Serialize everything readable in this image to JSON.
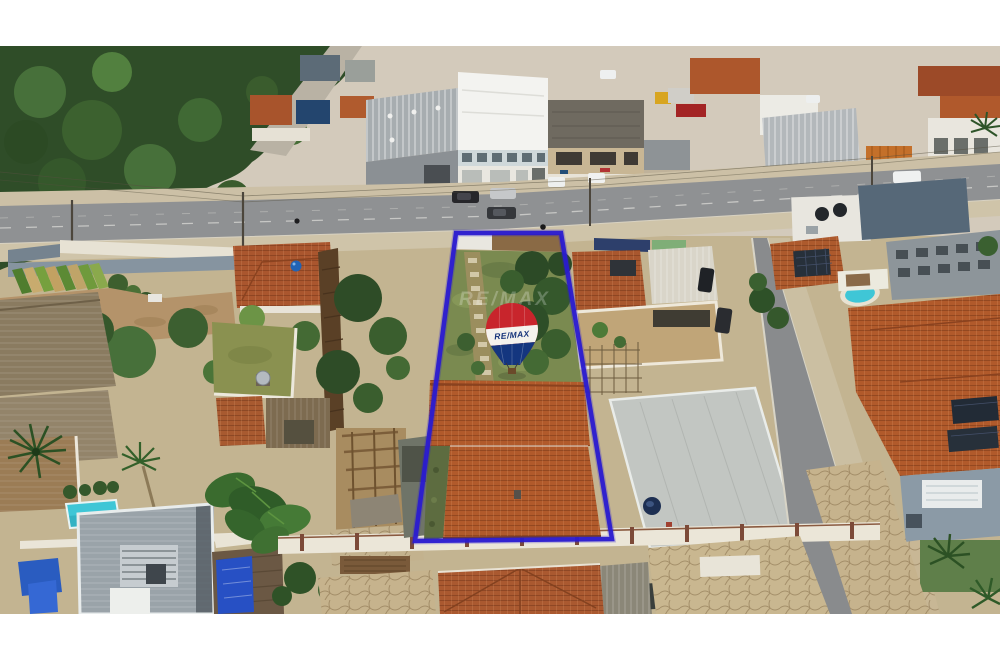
{
  "scene": {
    "description": "Aerial drone photo of a residential block; a deep-blue outline marks a long narrow lot with a grassy yard and a terracotta tile-roof house, RE/MAX balloon watermark at center, main avenue with shops above, neighboring houses, pools and palm trees around.",
    "letterbox_color": "#ffffff"
  },
  "watermark": {
    "ghost_text": "RE/MAX",
    "balloon_label": "RE/MAX"
  },
  "colors": {
    "boundary_outline": "#2a1bd0",
    "balloon_red": "#c8252c",
    "balloon_white": "#f4f2ed",
    "balloon_blue": "#14367f",
    "balloon_text": "#15337a",
    "road_asphalt": "#8f9193",
    "lot_grass": "#7a8a50",
    "roof_terracotta": "#b15a2b",
    "pool_water": "#3fc6d6",
    "tree_canopy": "#2f4d28"
  }
}
